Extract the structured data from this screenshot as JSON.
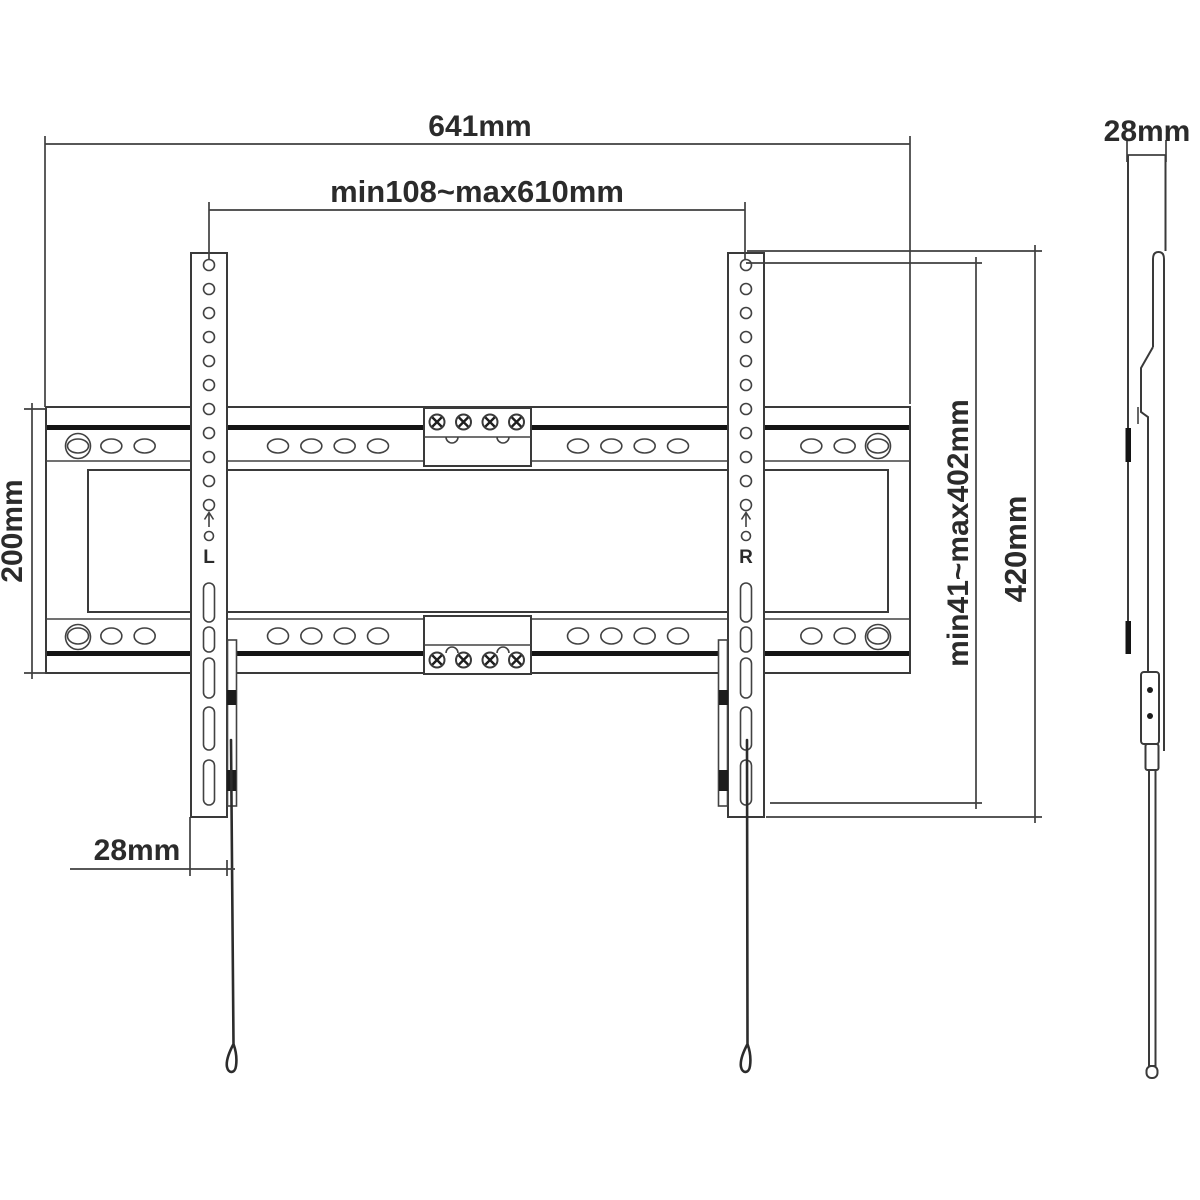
{
  "page": {
    "background": "#ffffff",
    "kind": "technical dimensional drawing of a TV wall-mount bracket"
  },
  "colors": {
    "line": "#3a3a3a",
    "line_dark": "#141414",
    "text": "#2b2b2b",
    "fill": "#ffffff"
  },
  "front_view": {
    "dim_total_width": "641mm",
    "dim_rail_range": "min108~max610mm",
    "dim_plate_height": "200mm",
    "dim_bracket_depth": "28mm",
    "dim_vesa_range": "min41~max402mm",
    "dim_bracket_height": "420mm",
    "left_bracket_label": "L",
    "right_bracket_label": "R"
  },
  "side_view": {
    "dim_depth": "28mm"
  },
  "drawing": {
    "rails": [
      {
        "y": 446,
        "ry": 7
      },
      {
        "y": 636,
        "ry": 8
      }
    ],
    "slot": {
      "rx": 10.5,
      "start": 78,
      "end": 878,
      "count": 25
    },
    "slot_skip": [
      [
        183,
        236
      ],
      [
        417,
        538
      ],
      [
        721,
        771
      ]
    ],
    "corner_hooks": {
      "r": 12.5,
      "xs": [
        78,
        878
      ],
      "ys": [
        446,
        637
      ]
    },
    "vesa": {
      "xs": [
        209,
        746
      ],
      "hole_r": 5.5,
      "holes_start": 265,
      "holes_pitch": 24,
      "holes_count": 11,
      "capsule_w": 11,
      "capsules": [
        [
          583,
          622
        ],
        [
          627,
          652
        ],
        [
          658,
          698
        ],
        [
          707,
          750
        ],
        [
          760,
          805
        ]
      ]
    },
    "screws": {
      "xs": [
        437,
        463.5,
        490,
        516.5
      ],
      "rows": [
        422,
        660
      ],
      "r": 7.5
    }
  }
}
